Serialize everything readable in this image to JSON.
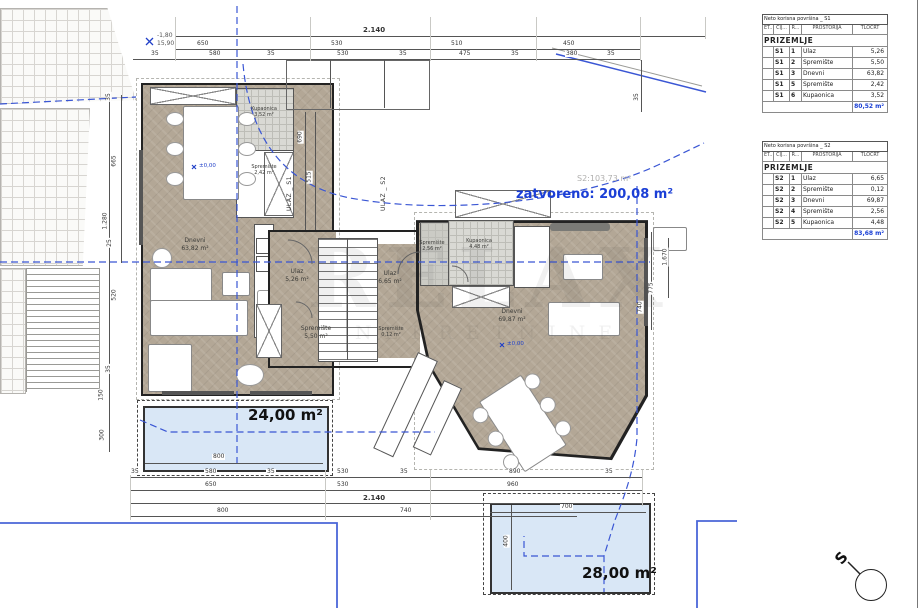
{
  "tables": [
    {
      "title": "Neto korisna površina _ S1",
      "cols": [
        "ET...",
        "CIJ...",
        "R...",
        "PROSTORIJA",
        "TLOCRT"
      ],
      "section": "PRIZEMLJE",
      "rows": [
        [
          "S1",
          "1",
          "Ulaz",
          "5,26"
        ],
        [
          "S1",
          "2",
          "Spremište",
          "5,50"
        ],
        [
          "S1",
          "3",
          "Dnevni",
          "63,82"
        ],
        [
          "S1",
          "5",
          "Spremište",
          "2,42"
        ],
        [
          "S1",
          "6",
          "Kupaonica",
          "3,52"
        ]
      ],
      "total": "80,52 m²"
    },
    {
      "title": "Neto korisna površina _ S2",
      "cols": [
        "ET...",
        "CIJ...",
        "R...",
        "PROSTORIJA",
        "TLOCRT"
      ],
      "section": "PRIZEMLJE",
      "rows": [
        [
          "S2",
          "1",
          "Ulaz",
          "6,65"
        ],
        [
          "S2",
          "2",
          "Spremište",
          "0,12"
        ],
        [
          "S2",
          "3",
          "Dnevni",
          "69,87"
        ],
        [
          "S2",
          "4",
          "Spremište",
          "2,56"
        ],
        [
          "S2",
          "5",
          "Kupaonica",
          "4,48"
        ]
      ],
      "total": "83,68 m²"
    }
  ],
  "rooms": {
    "s1_dnevni": {
      "name": "Dnevni",
      "area": "63,82 m²"
    },
    "s1_ulaz": {
      "name": "Ulaz",
      "area": "5,26 m²"
    },
    "s1_sprem1": {
      "name": "Spremište",
      "area": "5,50 m²"
    },
    "s1_sprem2": {
      "name": "Spremište",
      "area": "2,42 m²"
    },
    "s1_kupaonica": {
      "name": "Kupaonica",
      "area": "3,52 m²"
    },
    "s2_dnevni": {
      "name": "Dnevni",
      "area": "69,87 m²"
    },
    "s2_ulaz": {
      "name": "Ulaz",
      "area": "6,65 m²"
    },
    "s2_sprem1": {
      "name": "Spremište",
      "area": "0,12 m²"
    },
    "s2_sprem2": {
      "name": "Spremište",
      "area": "2,56 m²"
    },
    "s2_kupaonica": {
      "name": "Kupaonica",
      "area": "4,48 m²"
    }
  },
  "labels": {
    "zatvoreno": "zatvoreno: 200,08 m²",
    "s2_bruto": "S2:103,73 m²",
    "pool1": "24,00 m²",
    "pool2": "28,00 m²",
    "ulaz_s1": "ULAZ _ S1",
    "ulaz_s2": "ULAZ _ S2",
    "level_s1": "±0,00",
    "level_s2": "±0,00",
    "bench_top": "-1,80",
    "bench_bottom": "15,90",
    "compass": "S"
  },
  "watermark": {
    "line1": "RELAX",
    "line2": "NEKRETNINE"
  },
  "dims": {
    "top1": [
      "2.140"
    ],
    "top2": [
      "650",
      "530",
      "510",
      "450"
    ],
    "top3": [
      "35",
      "580",
      "35",
      "530",
      "35",
      "475",
      "35",
      "380",
      "35"
    ],
    "pool1": [
      "800"
    ],
    "bot1": [
      "35",
      "580",
      "35",
      "530",
      "35",
      "890",
      "35"
    ],
    "bot2": [
      "650",
      "530",
      "960"
    ],
    "bot3": [
      "2.140"
    ],
    "bot4": [
      "800",
      "740"
    ],
    "pool2": [
      "700",
      "400"
    ],
    "left": [
      "35",
      "665",
      "1.280",
      "25",
      "520",
      "35",
      "150",
      "300"
    ],
    "right": [
      "35",
      "1.670",
      "775",
      "740"
    ],
    "mid": [
      "690",
      "515"
    ]
  },
  "colors": {
    "boundary_blue": "#3a56d4",
    "label_blue": "#1b3fd6",
    "total_blue": "#1a3fd4",
    "floor_beige": "#b3a796",
    "pool_fill": "#d9e7f6"
  }
}
